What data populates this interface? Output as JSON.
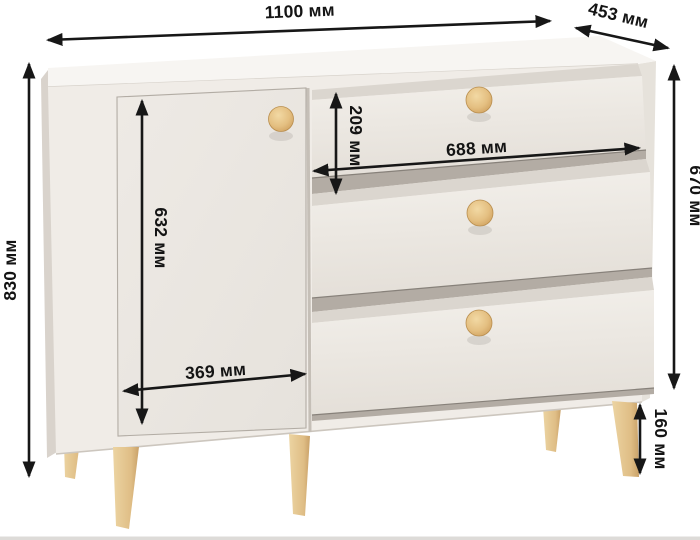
{
  "diagram": {
    "unit_suffix": "мм",
    "labels": {
      "total_width": "1100 мм",
      "depth": "453 мм",
      "total_height": "830 мм",
      "body_height": "670 мм",
      "door_height": "632 мм",
      "door_width": "369 мм",
      "top_drawer_height": "209 мм",
      "drawer_width": "688 мм",
      "leg_height": "160 мм"
    },
    "colors": {
      "background": "#ffffff",
      "dimension_ink": "#171717",
      "cabinet_top": "#f7f5f2",
      "cabinet_front": "#f0ece7",
      "cabinet_right_side": "#e6e2db",
      "cabinet_left_side": "#d9d3cc",
      "door_front": "#ebe7e2",
      "drawer_front": "#ece8e2",
      "drawer_recess": "#dbd6cf",
      "drawer_gap": "#b3aca4",
      "knob_wood": "#e4c083",
      "leg_wood": "#e0c08c",
      "floor_strip": "#dddbd8"
    }
  }
}
